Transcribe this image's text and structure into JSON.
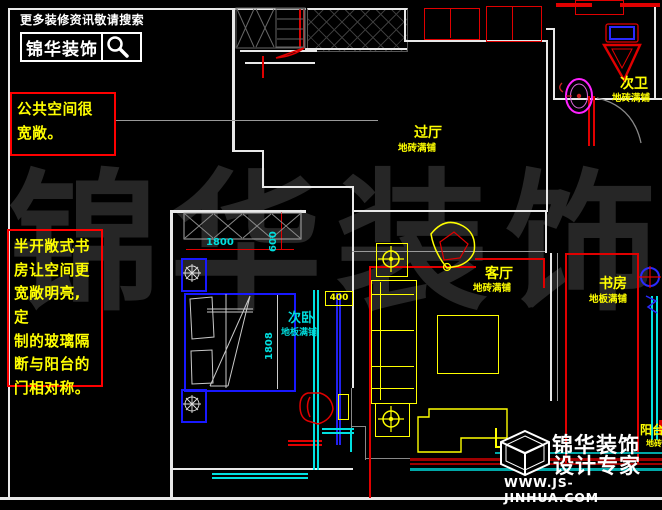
{
  "header": {
    "tagline": "更多装修资讯敬请搜索",
    "brand": "锦华装饰"
  },
  "annotations": [
    {
      "text": "公共空间很\n宽敞。"
    },
    {
      "text": "半开敞式书\n房让空间更\n宽敞明亮,定\n制的玻璃隔\n断与阳台的\n门相对称。"
    }
  ],
  "watermark": {
    "chars": [
      "锦",
      "华",
      "装",
      "饰"
    ]
  },
  "rooms": {
    "hallway": {
      "name": "过厅",
      "finish": "地砖满铺"
    },
    "bath2": {
      "name": "次卫",
      "finish": "地砖满铺"
    },
    "bedroom2": {
      "name": "次卧",
      "finish": "地板满铺"
    },
    "living": {
      "name": "客厅",
      "finish": "地砖满铺"
    },
    "study": {
      "name": "书房",
      "finish": "地板满铺"
    },
    "balcony": {
      "name": "阳台",
      "finish": "地砖满铺"
    }
  },
  "dimensions": {
    "wardrobe_width": "1800",
    "wardrobe_depth": "600",
    "bed_length": "1808",
    "partition_offset": "400"
  },
  "footer": {
    "brand_line1": "锦华装饰",
    "brand_line2": "设计专家",
    "website": "WWW.JS-JINHUA.COM"
  },
  "colors": {
    "wall": "#ffffff",
    "annotation_box": "#ff0000",
    "room_label": "#ffff00",
    "bedroom_label": "#00dddd",
    "dimension_text": "#00e0e0",
    "furniture": "#ffff00",
    "bed": "#1818ff",
    "glass_partition": "#00e0e0",
    "washbasin": "#ff22ff",
    "stripe_teal": "#00a8a8",
    "stripe_dark_red": "#a00000"
  }
}
